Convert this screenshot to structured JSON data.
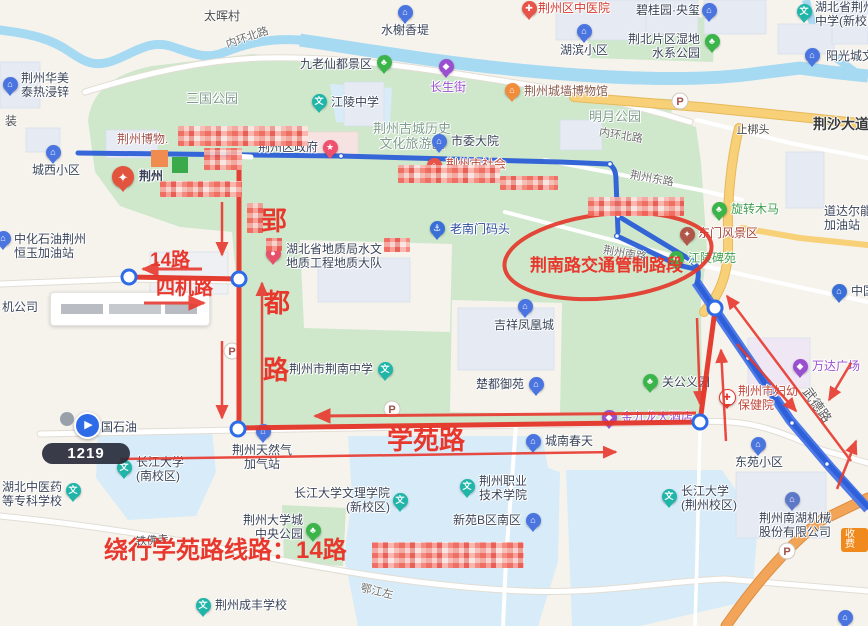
{
  "annotations": {
    "yingdu_road": "郢都路",
    "route_label": "14路",
    "siji_road": "四机路",
    "control_zone": "荆南路交通管制路段",
    "xueyuan_road": "学苑路",
    "detour_note": "绕行学苑路线路：14路",
    "accent_color": "#e8382e"
  },
  "tooltip": {
    "value": "1219"
  },
  "toll_badge": {
    "label": "收费"
  },
  "nav_poi": {
    "label": "国石油"
  },
  "route_colors": {
    "bus_route": "#2c5fd8",
    "detour": "#e33427"
  },
  "pois": [
    {
      "name": "shuixie-xiangdi",
      "pin": {
        "x": 405,
        "y": 12,
        "color": "#4a74e0",
        "glyph": "⌂"
      },
      "label": {
        "lines": [
          "水榭香堤"
        ],
        "x": 405,
        "y": 24,
        "align": "center"
      }
    },
    {
      "name": "jingzhouqu-zhongyiyuan",
      "pin": {
        "x": 529,
        "y": 8,
        "color": "#e8544a",
        "glyph": "✚"
      },
      "label": {
        "lines": [
          "荆州区中医院"
        ],
        "x": 538,
        "y": 2,
        "align": "left",
        "color": "#d63a2f"
      }
    },
    {
      "name": "biguiyuan-yangxi",
      "pin": {
        "x": 709,
        "y": 10,
        "color": "#4a74e0",
        "glyph": "⌂"
      },
      "label": {
        "lines": [
          "碧桂园·央玺"
        ],
        "x": 700,
        "y": 4,
        "align": "right"
      }
    },
    {
      "name": "hubei-jingzhou-zhongxue",
      "pin": {
        "x": 804,
        "y": 11,
        "color": "#1fb5a9",
        "glyph": "文"
      },
      "label": {
        "lines": [
          "湖北省荆州",
          "中学(新校区)"
        ],
        "x": 815,
        "y": 1,
        "align": "left"
      }
    },
    {
      "name": "hubin-xiaoqu",
      "pin": {
        "x": 584,
        "y": 31,
        "color": "#4a74e0",
        "glyph": "⌂"
      },
      "label": {
        "lines": [
          "湖滨小区"
        ],
        "x": 584,
        "y": 44,
        "align": "center"
      }
    },
    {
      "name": "jingbei-shidi-park",
      "pin": {
        "x": 712,
        "y": 41,
        "color": "#3bb54a",
        "glyph": "♣"
      },
      "label": {
        "lines": [
          "荆北片区湿地",
          "水系公园"
        ],
        "x": 700,
        "y": 33,
        "align": "right"
      }
    },
    {
      "name": "yangguangcheng",
      "pin": {
        "x": 812,
        "y": 55,
        "color": "#4a74e0",
        "glyph": "⌂"
      },
      "label": {
        "lines": [
          "阳光城文"
        ],
        "x": 826,
        "y": 50,
        "align": "left"
      }
    },
    {
      "name": "jiulao-xiandu",
      "pin": {
        "x": 384,
        "y": 62,
        "color": "#3bb54a",
        "glyph": "♣"
      },
      "label": {
        "lines": [
          "九老仙都景区"
        ],
        "x": 372,
        "y": 58,
        "align": "right"
      }
    },
    {
      "name": "changshengjie",
      "pin": {
        "x": 446,
        "y": 66,
        "color": "#9a4fd0",
        "glyph": "◆"
      },
      "label": {
        "lines": [
          "长生街"
        ],
        "x": 448,
        "y": 81,
        "align": "center",
        "color": "#9a4fd0"
      }
    },
    {
      "name": "jiangling-zhongxue",
      "pin": {
        "x": 319,
        "y": 101,
        "color": "#1fb5a9",
        "glyph": "文"
      },
      "label": {
        "lines": [
          "江陵中学"
        ],
        "x": 331,
        "y": 96,
        "align": "left"
      }
    },
    {
      "name": "gucheng-lvyouqu",
      "pin": null,
      "label": {
        "lines": [
          "荆州古城历史",
          "文化旅游区"
        ],
        "x": 412,
        "y": 122,
        "align": "center",
        "color": "#7f9d8e",
        "size": 13
      }
    },
    {
      "name": "chengqiang-bowuguan",
      "pin": {
        "x": 512,
        "y": 90,
        "color": "#f08c3a",
        "glyph": "⌂"
      },
      "label": {
        "lines": [
          "荆州城墙博物馆"
        ],
        "x": 524,
        "y": 85,
        "align": "left",
        "color": "#8a5a4a"
      }
    },
    {
      "name": "mingyue-park",
      "pin": null,
      "label": {
        "lines": [
          "明月公园"
        ],
        "x": 615,
        "y": 110,
        "align": "center",
        "color": "#7f9d8e",
        "size": 13
      }
    },
    {
      "name": "shiwei-dayuan",
      "pin": {
        "x": 439,
        "y": 141,
        "color": "#4a74e0",
        "glyph": "⌂"
      },
      "label": {
        "lines": [
          "市委大院"
        ],
        "x": 451,
        "y": 135,
        "align": "left"
      }
    },
    {
      "name": "jingzhou-bowuguan",
      "pin": null,
      "label": {
        "lines": [
          "荆州博物."
        ],
        "x": 117,
        "y": 133,
        "align": "left",
        "color": "#a3524a"
      }
    },
    {
      "name": "jingzhou-badge",
      "pin": {
        "x": 123,
        "y": 177,
        "color": "#e2543e",
        "glyph": "✦",
        "size": 22
      },
      "label": {
        "lines": [
          "荆州"
        ],
        "x": 139,
        "y": 170,
        "align": "left",
        "bold": true
      }
    },
    {
      "name": "jingzhouqu-zhengfu",
      "pin": {
        "x": 330,
        "y": 147,
        "color": "#f0506e",
        "glyph": "★"
      },
      "label": {
        "lines": [
          "荆州区政府"
        ],
        "x": 318,
        "y": 141,
        "align": "right"
      }
    },
    {
      "name": "sanguo-park",
      "pin": null,
      "label": {
        "lines": [
          "三国公园"
        ],
        "x": 212,
        "y": 92,
        "align": "center",
        "color": "#7f9d8e",
        "size": 13
      }
    },
    {
      "name": "jingzhou-huamei",
      "pin": {
        "x": 10,
        "y": 84,
        "color": "#4a74e0",
        "glyph": "⌂"
      },
      "label": {
        "lines": [
          "荆州华美",
          "泰热浸锌"
        ],
        "x": 21,
        "y": 72,
        "align": "left"
      }
    },
    {
      "name": "zhuang-cut",
      "pin": null,
      "label": {
        "lines": [
          "装"
        ],
        "x": 5,
        "y": 115,
        "align": "left",
        "color": "#4a4a4a"
      }
    },
    {
      "name": "chengxi-xiaoqu",
      "pin": {
        "x": 53,
        "y": 152,
        "color": "#4a74e0",
        "glyph": "⌂"
      },
      "label": {
        "lines": [
          "城西小区"
        ],
        "x": 56,
        "y": 164,
        "align": "center"
      }
    },
    {
      "name": "zhonghua-shiyou",
      "pin": {
        "x": 3,
        "y": 238,
        "color": "#4a74e0",
        "glyph": "⌂"
      },
      "label": {
        "lines": [
          "中化石油荆州",
          "恒玉加油站"
        ],
        "x": 14,
        "y": 233,
        "align": "left"
      }
    },
    {
      "name": "ji-gongsi",
      "pin": null,
      "label": {
        "lines": [
          "机公司"
        ],
        "x": 2,
        "y": 301,
        "align": "left"
      }
    },
    {
      "name": "dizhi-dadui",
      "pin": {
        "x": 273,
        "y": 253,
        "color": "#e8506a",
        "glyph": "●"
      },
      "label": {
        "lines": [
          "湖北省地质局水文",
          "地质工程地质大队"
        ],
        "x": 286,
        "y": 243,
        "align": "left"
      }
    },
    {
      "name": "laonanmen-matou",
      "pin": {
        "x": 437,
        "y": 228,
        "color": "#3a6fd8",
        "glyph": "⚓"
      },
      "label": {
        "lines": [
          "老南门码头"
        ],
        "x": 450,
        "y": 223,
        "align": "left",
        "color": "#2d4f9e"
      }
    },
    {
      "name": "shehui-poi",
      "pin": {
        "x": 434,
        "y": 165,
        "color": "#e8544a",
        "glyph": "⌂"
      },
      "label": {
        "lines": [
          "荆州市社会"
        ],
        "x": 446,
        "y": 158,
        "align": "left",
        "color": "#bb4a3e"
      }
    },
    {
      "name": "jixiang-fenghuangcheng",
      "pin": {
        "x": 525,
        "y": 306,
        "color": "#4a74e0",
        "glyph": "⌂"
      },
      "label": {
        "lines": [
          "吉祥凤凰城"
        ],
        "x": 524,
        "y": 319,
        "align": "center"
      }
    },
    {
      "name": "chudu-yuyuan",
      "pin": {
        "x": 536,
        "y": 384,
        "color": "#4a74e0",
        "glyph": "⌂"
      },
      "label": {
        "lines": [
          "楚都御苑"
        ],
        "x": 524,
        "y": 378,
        "align": "right"
      }
    },
    {
      "name": "guangong-yiyuan",
      "pin": {
        "x": 650,
        "y": 381,
        "color": "#3bb54a",
        "glyph": "♣"
      },
      "label": {
        "lines": [
          "关公义园"
        ],
        "x": 662,
        "y": 376,
        "align": "left"
      }
    },
    {
      "name": "jinjiulong-hotel",
      "pin": {
        "x": 609,
        "y": 417,
        "color": "#9a4fd0",
        "glyph": "◆"
      },
      "label": {
        "lines": [
          "金九龙大酒店"
        ],
        "x": 621,
        "y": 411,
        "align": "left",
        "color": "#9a4fd0"
      }
    },
    {
      "name": "chengnan-chuntian",
      "pin": {
        "x": 533,
        "y": 441,
        "color": "#4a74e0",
        "glyph": "⌂"
      },
      "label": {
        "lines": [
          "城南春天"
        ],
        "x": 545,
        "y": 435,
        "align": "left"
      }
    },
    {
      "name": "fuyou-baojianyuan",
      "pin": {
        "x": 726,
        "y": 396,
        "color": "#ffffff",
        "glyph": "✚",
        "glyph_color": "#e03a30",
        "ring": "#e03a30"
      },
      "label": {
        "lines": [
          "荆州市妇幼",
          "保健院"
        ],
        "x": 738,
        "y": 385,
        "align": "left",
        "color": "#c2473a"
      }
    },
    {
      "name": "wanda-plaza",
      "pin": {
        "x": 800,
        "y": 366,
        "color": "#9a4fd0",
        "glyph": "◆"
      },
      "label": {
        "lines": [
          "万达广场"
        ],
        "x": 812,
        "y": 360,
        "align": "left",
        "color": "#9a4fd0"
      }
    },
    {
      "name": "dongyuan-xiaoqu",
      "pin": {
        "x": 758,
        "y": 444,
        "color": "#4a74e0",
        "glyph": "⌂"
      },
      "label": {
        "lines": [
          "东苑小区"
        ],
        "x": 759,
        "y": 456,
        "align": "center"
      }
    },
    {
      "name": "changda-jingzhou",
      "pin": {
        "x": 669,
        "y": 496,
        "color": "#1fb5a9",
        "glyph": "文"
      },
      "label": {
        "lines": [
          "长江大学",
          "(荆州校区)"
        ],
        "x": 681,
        "y": 485,
        "align": "left"
      }
    },
    {
      "name": "nanhu-jixie",
      "pin": {
        "x": 792,
        "y": 499,
        "color": "#5d78c8",
        "glyph": "⌂"
      },
      "label": {
        "lines": [
          "荆州南湖机械",
          "股份有限公司"
        ],
        "x": 795,
        "y": 512,
        "align": "center"
      }
    },
    {
      "name": "xinyuan-b",
      "pin": {
        "x": 533,
        "y": 520,
        "color": "#4a74e0",
        "glyph": "⌂"
      },
      "label": {
        "lines": [
          "新苑B区南区"
        ],
        "x": 521,
        "y": 514,
        "align": "right"
      }
    },
    {
      "name": "zhiye-jishu-xueyuan",
      "pin": {
        "x": 467,
        "y": 486,
        "color": "#1fb5a9",
        "glyph": "文"
      },
      "label": {
        "lines": [
          "荆州职业",
          "技术学院"
        ],
        "x": 479,
        "y": 475,
        "align": "left"
      }
    },
    {
      "name": "wenli-xueyuan",
      "pin": {
        "x": 400,
        "y": 500,
        "color": "#1fb5a9",
        "glyph": "文"
      },
      "label": {
        "lines": [
          "长江大学文理学院",
          "(新校区)"
        ],
        "x": 390,
        "y": 487,
        "align": "right"
      }
    },
    {
      "name": "daxuecheng-park",
      "pin": {
        "x": 313,
        "y": 530,
        "color": "#3bb54a",
        "glyph": "♣"
      },
      "label": {
        "lines": [
          "荆州大学城",
          "中央公园"
        ],
        "x": 303,
        "y": 514,
        "align": "right"
      }
    },
    {
      "name": "chengfeng-school",
      "pin": {
        "x": 203,
        "y": 605,
        "color": "#1fb5a9",
        "glyph": "文"
      },
      "label": {
        "lines": [
          "荆州成丰学校"
        ],
        "x": 215,
        "y": 599,
        "align": "left"
      }
    },
    {
      "name": "zhongyiyao-zhuanke",
      "pin": {
        "x": 73,
        "y": 490,
        "color": "#1fb5a9",
        "glyph": "文"
      },
      "label": {
        "lines": [
          "湖北中医药",
          "等专科学校"
        ],
        "x": 62,
        "y": 481,
        "align": "right"
      }
    },
    {
      "name": "changda-nan",
      "pin": {
        "x": 124,
        "y": 467,
        "color": "#1fb5a9",
        "glyph": "文"
      },
      "label": {
        "lines": [
          "长江大学",
          "(南校区)"
        ],
        "x": 136,
        "y": 456,
        "align": "left"
      }
    },
    {
      "name": "tianranqi-jiaqizhan",
      "pin": {
        "x": 263,
        "y": 431,
        "color": "#4a74e0",
        "glyph": "⌂"
      },
      "label": {
        "lines": [
          "荆州天然气",
          "加气站"
        ],
        "x": 262,
        "y": 444,
        "align": "center"
      }
    },
    {
      "name": "jingnan-zhongxue",
      "pin": {
        "x": 385,
        "y": 369,
        "color": "#1fb5a9",
        "glyph": "文"
      },
      "label": {
        "lines": [
          "荆州市荆南中学"
        ],
        "x": 373,
        "y": 363,
        "align": "right"
      }
    },
    {
      "name": "dongmen-fengjingqu",
      "pin": {
        "x": 687,
        "y": 234,
        "color": "#b0574a",
        "glyph": "✦"
      },
      "label": {
        "lines": [
          "东门风景区"
        ],
        "x": 698,
        "y": 227,
        "align": "left",
        "color": "#a8463c"
      }
    },
    {
      "name": "xuanzhuan-muma",
      "pin": {
        "x": 719,
        "y": 209,
        "color": "#3bb54a",
        "glyph": "♣"
      },
      "label": {
        "lines": [
          "旋转木马"
        ],
        "x": 731,
        "y": 203,
        "align": "left",
        "color": "#3f9e4f"
      }
    },
    {
      "name": "jiangling-beiyuan",
      "pin": {
        "x": 676,
        "y": 258,
        "color": "#3bb54a",
        "glyph": "♣"
      },
      "label": {
        "lines": [
          "江陵碑苑"
        ],
        "x": 688,
        "y": 252,
        "align": "left",
        "color": "#3f9e4f"
      }
    },
    {
      "name": "daodaer-jiayou",
      "pin": null,
      "label": {
        "lines": [
          "道达尔能源",
          "加油站"
        ],
        "x": 824,
        "y": 205,
        "align": "left"
      }
    },
    {
      "name": "zhongguo-shihua",
      "pin": {
        "x": 839,
        "y": 291,
        "color": "#3a6fd8",
        "glyph": "⌂"
      },
      "label": {
        "lines": [
          "中国石化"
        ],
        "x": 851,
        "y": 285,
        "align": "left"
      }
    },
    {
      "name": "corner-pin",
      "pin": {
        "x": 845,
        "y": 617,
        "color": "#4a74e0",
        "glyph": "⌂"
      },
      "label": null
    }
  ],
  "road_labels": [
    {
      "text": "太晖村",
      "x": 222,
      "y": 7,
      "rot": 0,
      "size": 12,
      "color": "#4a4a4a"
    },
    {
      "text": "内环北路",
      "x": 247,
      "y": 29,
      "rot": -19,
      "size": 11,
      "color": "#6e6e6e"
    },
    {
      "text": "内环北路",
      "x": 621,
      "y": 127,
      "rot": 9,
      "size": 11,
      "color": "#6e6e6e"
    },
    {
      "text": "荆州东路",
      "x": 652,
      "y": 170,
      "rot": 10,
      "size": 11,
      "color": "#6e6e6e"
    },
    {
      "text": "荆沙大道",
      "x": 841,
      "y": 114,
      "rot": 0,
      "size": 14,
      "color": "#3a3a3a",
      "bold": true
    },
    {
      "text": "止梆头",
      "x": 753,
      "y": 121,
      "rot": 0,
      "size": 11,
      "color": "#4a4a4a"
    },
    {
      "text": "荆州南路",
      "x": 625,
      "y": 245,
      "rot": 10,
      "size": 11,
      "color": "#6e6e6e"
    },
    {
      "text": "武德路",
      "x": 818,
      "y": 395,
      "rot": 55,
      "size": 13,
      "color": "#5a5a5a"
    },
    {
      "text": "鄂江左",
      "x": 377,
      "y": 583,
      "rot": 13,
      "size": 11,
      "color": "#6e6e6e"
    },
    {
      "text": "铁佛寺",
      "x": 152,
      "y": 532,
      "rot": -4,
      "size": 11,
      "color": "#4a4a4a"
    }
  ]
}
